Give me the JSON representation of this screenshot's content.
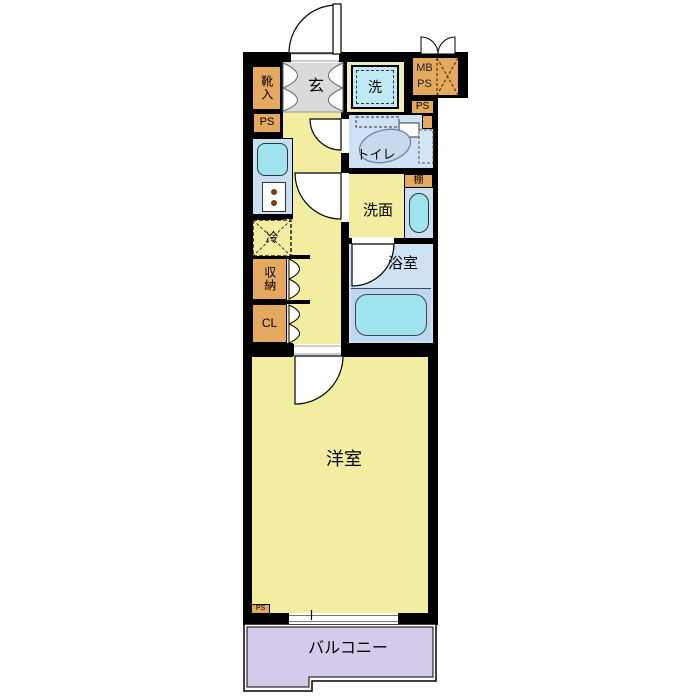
{
  "floorplan": {
    "labels": {
      "entrance": "玄",
      "shoe_cabinet": "靴入",
      "washer": "洗",
      "mb": "MB",
      "ps": "PS",
      "toilet": "トイレ",
      "shelf": "棚",
      "washroom": "洗面",
      "refrigerator": "冷",
      "storage": "収納",
      "closet": "CL",
      "bathroom": "浴室",
      "western_room": "洋室",
      "balcony": "バルコニー"
    },
    "colors": {
      "wall": "#000000",
      "floor-yellow": "#F2EDA0",
      "genkan-gray": "#DADADA",
      "cabinet-orange": "#E5A85F",
      "tile-blue": "#CFE2F3",
      "fixture-cyan": "#9FE3EF",
      "washer-blue": "#BFE9F4",
      "washer-mat": "#F0ECB9",
      "tub-zone-blue": "#BCD7EE",
      "balcony-purple": "#D6CAEB"
    }
  }
}
